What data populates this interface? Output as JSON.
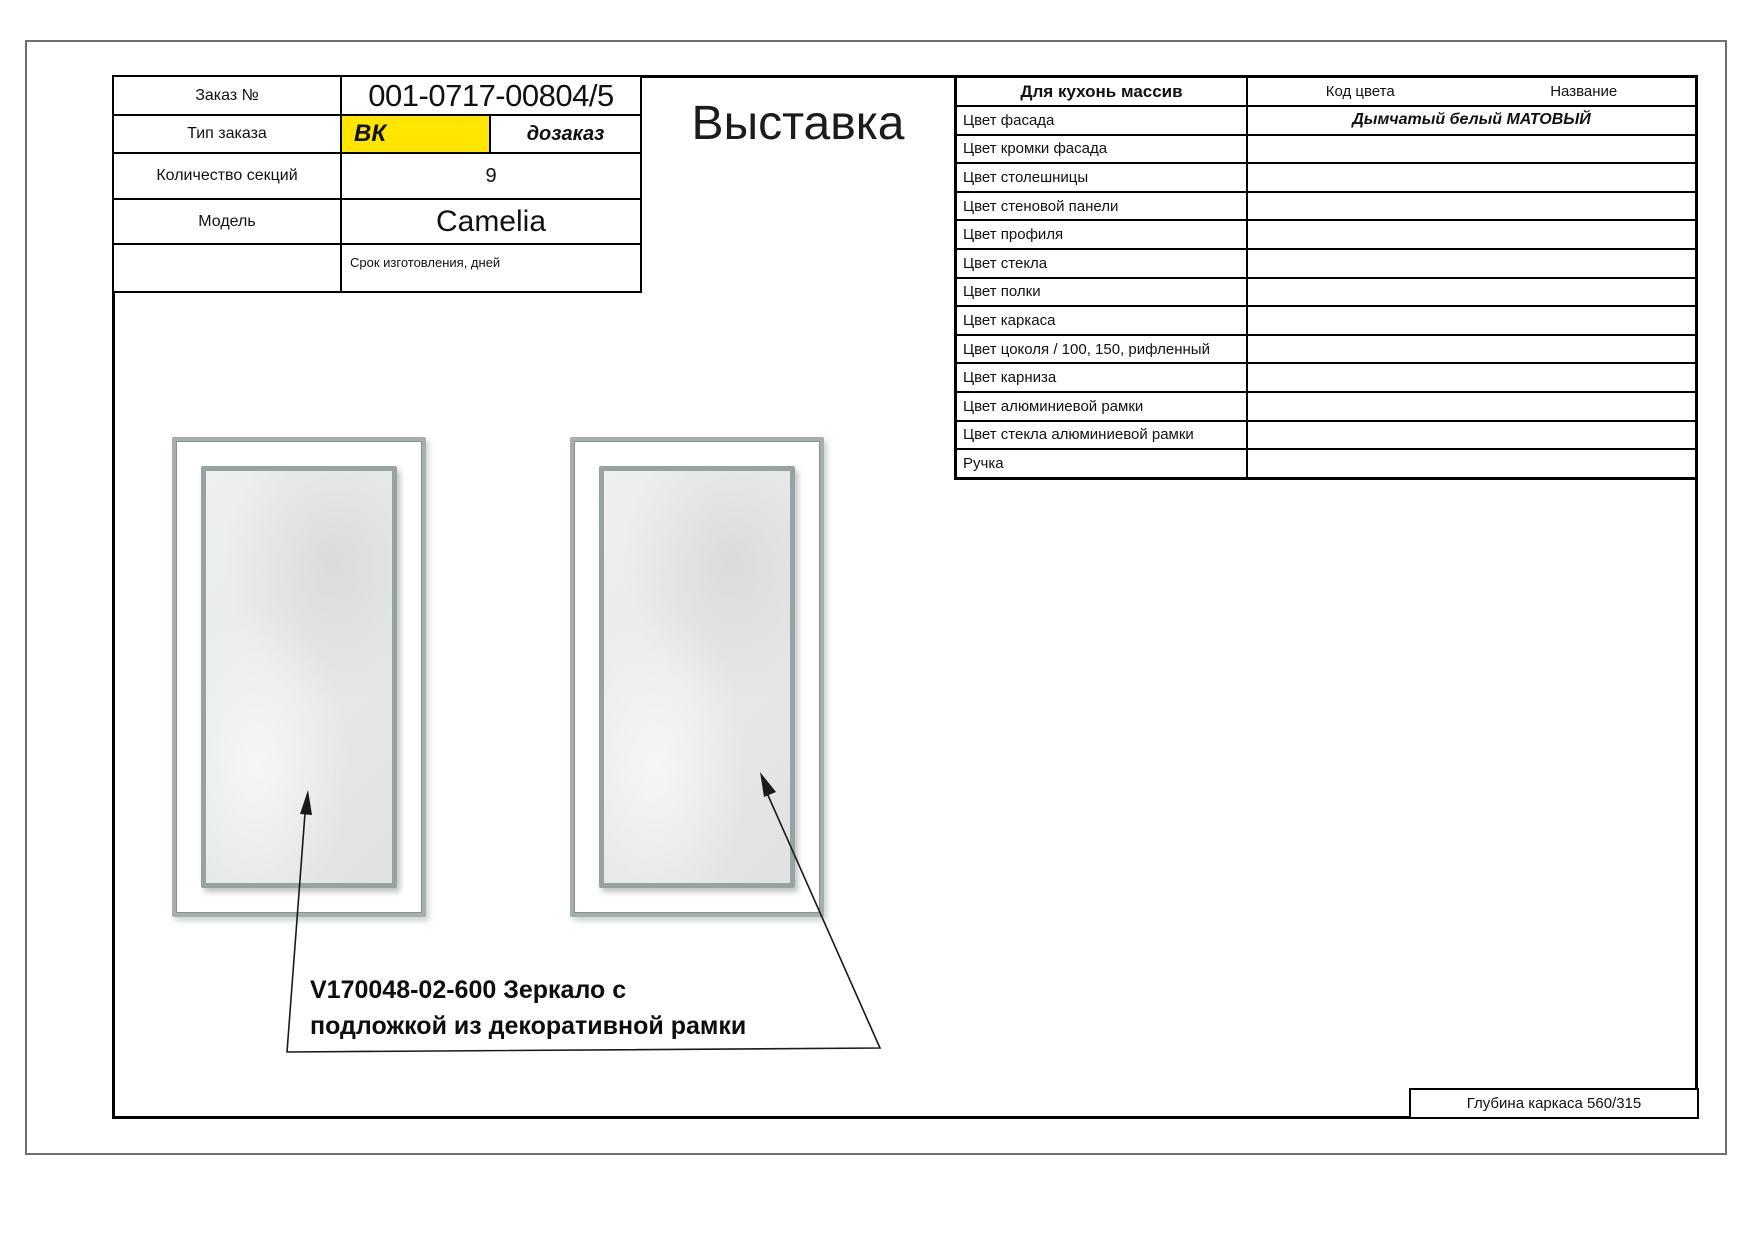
{
  "title": "Выставка",
  "order_info": {
    "rows": [
      {
        "label": "Заказ №",
        "value": "001-0717-00804/5"
      },
      {
        "label": "Тип заказа",
        "badge": "ВК",
        "badge2": "дозаказ"
      },
      {
        "label": "Количество секций",
        "value": "9"
      },
      {
        "label": "Модель",
        "value": "Camelia"
      },
      {
        "label": "",
        "value": "Срок изготовления, дней"
      }
    ],
    "highlight_color": "#ffe600"
  },
  "spec_table": {
    "title": "Для кухонь массив",
    "col_code": "Код цвета",
    "col_name": "Название",
    "rows": [
      {
        "label": "Цвет фасада",
        "value": "Дымчатый белый МАТОВЫЙ"
      },
      {
        "label": "Цвет кромки фасада",
        "value": ""
      },
      {
        "label": "Цвет столешницы",
        "value": ""
      },
      {
        "label": "Цвет стеновой панели",
        "value": ""
      },
      {
        "label": "Цвет профиля",
        "value": ""
      },
      {
        "label": "Цвет стекла",
        "value": ""
      },
      {
        "label": "Цвет полки",
        "value": ""
      },
      {
        "label": "Цвет каркаса",
        "value": ""
      },
      {
        "label": "Цвет цоколя / 100, 150, рифленный",
        "value": ""
      },
      {
        "label": "Цвет карниза",
        "value": ""
      },
      {
        "label": "Цвет алюминиевой рамки",
        "value": ""
      },
      {
        "label": "Цвет стекла алюминиевой рамки",
        "value": ""
      },
      {
        "label": "Ручка",
        "value": ""
      }
    ]
  },
  "drawing": {
    "caption_line1": "V170048-02-600 Зеркало с",
    "caption_line2": "подложкой из декоративной рамки"
  },
  "footer": {
    "frame_depth": "Глубина каркаса 560/315"
  }
}
